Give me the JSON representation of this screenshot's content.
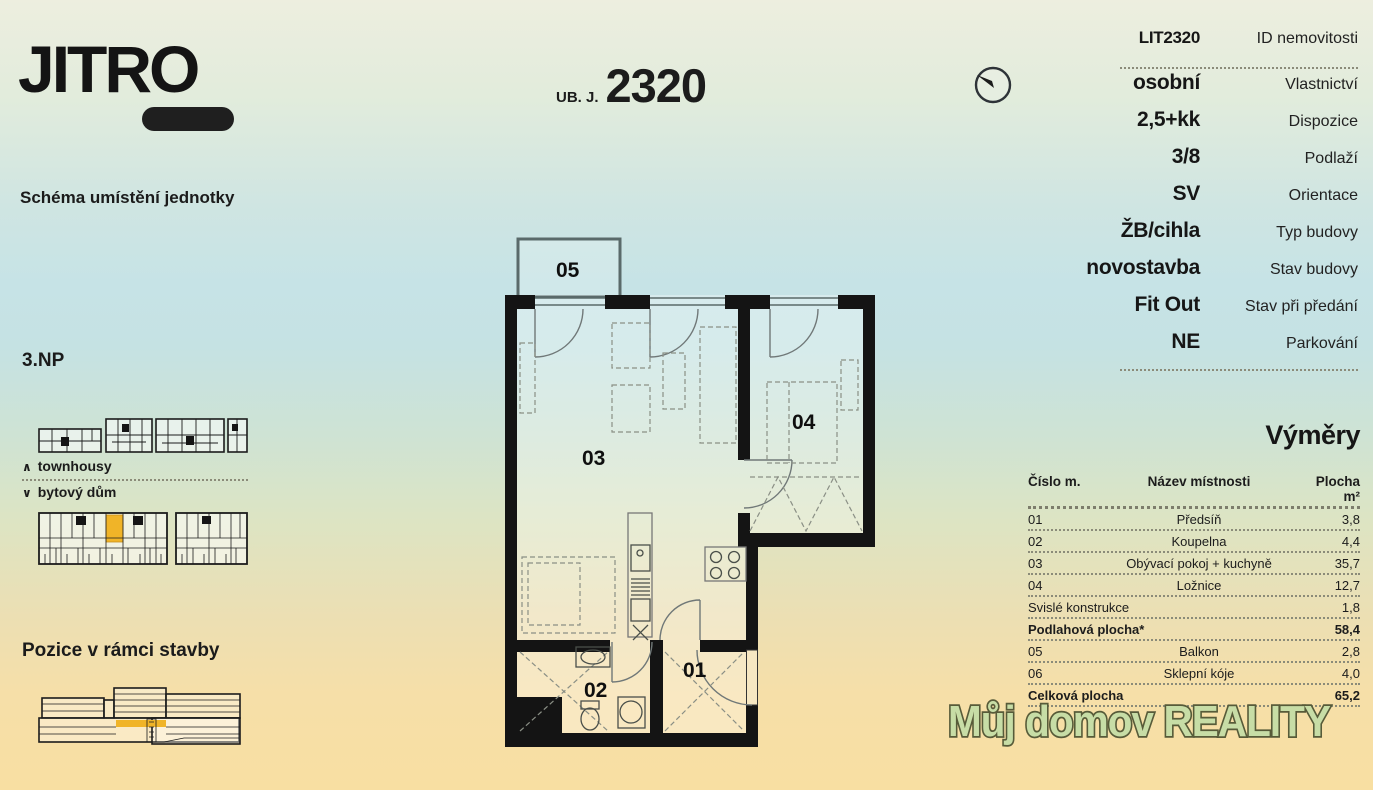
{
  "brand": {
    "logo_text": "JITRO"
  },
  "header": {
    "unit_prefix": "UB. J.",
    "unit_number": "2320"
  },
  "left_panel": {
    "scheme_title": "Schéma umístění jednotky",
    "floor_label": "3.NP",
    "legend_up_icon": "∧",
    "legend_up": "townhousy",
    "legend_down_icon": "∨",
    "legend_down": "bytový dům",
    "position_title": "Pozice v rámci stavby",
    "highlight_color": "#f0b428"
  },
  "details": {
    "rows": [
      {
        "value": "LIT2320",
        "label": "ID nemovitosti"
      },
      {
        "value": "osobní",
        "label": "Vlastnictví"
      },
      {
        "value": "2,5+kk",
        "label": "Dispozice"
      },
      {
        "value": "3/8",
        "label": "Podlaží"
      },
      {
        "value": "SV",
        "label": "Orientace"
      },
      {
        "value": "ŽB/cihla",
        "label": "Typ budovy"
      },
      {
        "value": "novostavba",
        "label": "Stav budovy"
      },
      {
        "value": "Fit Out",
        "label": "Stav při předání"
      },
      {
        "value": "NE",
        "label": "Parkování"
      }
    ]
  },
  "areas": {
    "title": "Výměry",
    "columns": {
      "num": "Číslo m.",
      "name": "Název místnosti",
      "area": "Plocha m²"
    },
    "rows": [
      {
        "num": "01",
        "name": "Předsíň",
        "area": "3,8"
      },
      {
        "num": "02",
        "name": "Koupelna",
        "area": "4,4"
      },
      {
        "num": "03",
        "name": "Obývací pokoj + kuchyně",
        "area": "35,7"
      },
      {
        "num": "04",
        "name": "Ložnice",
        "area": "12,7"
      },
      {
        "num": "Svislé konstrukce",
        "name": "",
        "area": "1,8"
      },
      {
        "num": "Podlahová plocha*",
        "name": "",
        "area": "58,4"
      },
      {
        "num": "05",
        "name": "Balkon",
        "area": "2,8"
      },
      {
        "num": "06",
        "name": "Sklepní kóje",
        "area": "4,0"
      },
      {
        "num": "Celková plocha",
        "name": "",
        "area": "65,2"
      }
    ]
  },
  "floorplan": {
    "rooms": {
      "r01": "01",
      "r02": "02",
      "r03": "03",
      "r04": "04",
      "r05": "05"
    }
  },
  "watermark": {
    "text": "Můj domov REALITY"
  }
}
